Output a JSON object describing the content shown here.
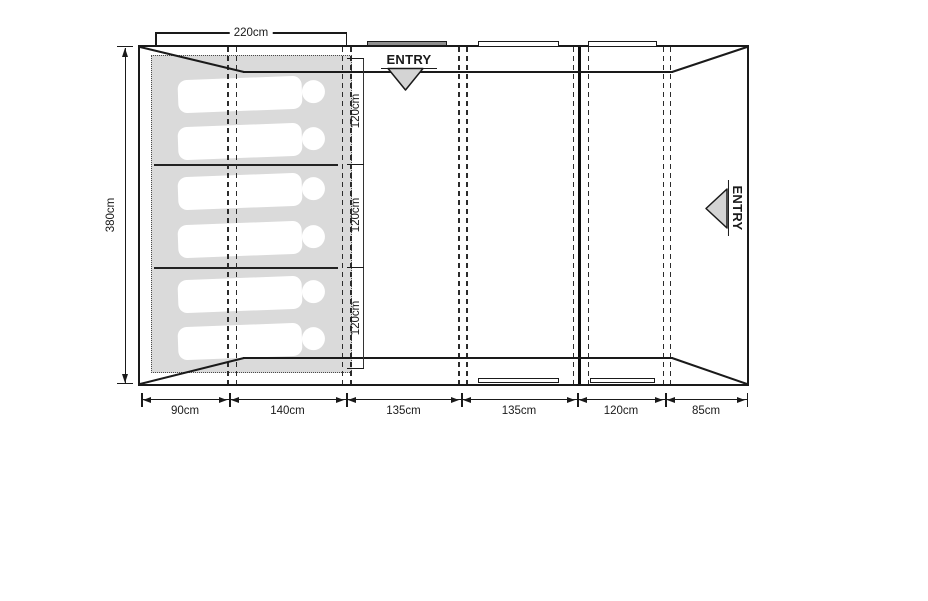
{
  "diagram_type": "tent floor plan (top view)",
  "colors": {
    "line": "#1a1a1a",
    "sleep_area_fill": "#dadada",
    "door_bar_gray": "#8f8f8f",
    "entry_arrow_fill": "#d4d4d4"
  },
  "entries": {
    "top_label": "ENTRY",
    "side_label": "ENTRY"
  },
  "sleeping_area": {
    "figure_count": 6,
    "width_label": "220cm",
    "section_labels": [
      "120cm",
      "120cm",
      "120cm"
    ]
  },
  "dimensions": {
    "depth_label": "380cm",
    "bottom_segments": [
      {
        "label": "90cm"
      },
      {
        "label": "140cm"
      },
      {
        "label": "135cm"
      },
      {
        "label": "135cm"
      },
      {
        "label": "120cm"
      },
      {
        "label": "85cm"
      }
    ]
  }
}
